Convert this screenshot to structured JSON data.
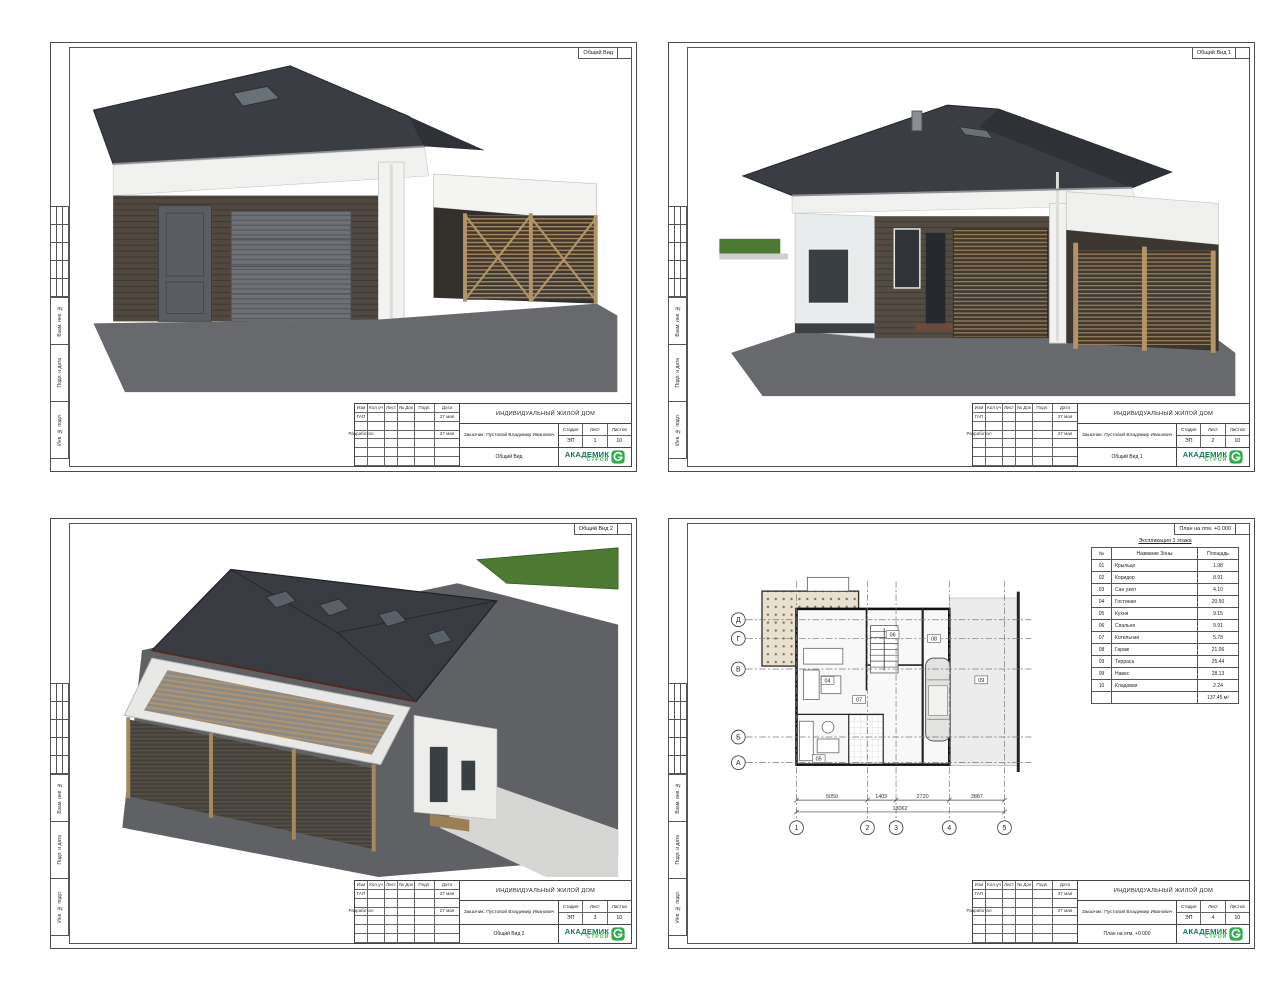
{
  "project": {
    "title": "ИНДИВИДУАЛЬНЫЙ ЖИЛОЙ ДОМ",
    "client": "Заказчик: Пустовой Владимир Иванович",
    "stage_label": "Стадия",
    "sheet_label": "Лист",
    "sheets_label": "Листов",
    "stage": "ЭП",
    "total_sheets": "10"
  },
  "titleblock": {
    "cols": [
      "Изм",
      "Кол.уч",
      "Лист",
      "№ Док",
      "Подп.",
      "Дата"
    ],
    "role1": "ГАП",
    "date1": "27 мая",
    "role2": "Разработал",
    "date2": "27 мая"
  },
  "logo": {
    "line1": "АКАДЕМИК",
    "line2": "СТРОЙ",
    "color1": "#0e7a4f",
    "color2": "#3bb54a"
  },
  "side_stamps": {
    "a": "Взам. инв. №",
    "b": "Подп. и дата",
    "c": "Инв. № подл."
  },
  "sheets": [
    {
      "name": "Общий Вид",
      "sheet_no": "1"
    },
    {
      "name": "Общий Вид 1",
      "sheet_no": "2"
    },
    {
      "name": "Общий Вид 2",
      "sheet_no": "3"
    },
    {
      "name": "План на отм. +0.000",
      "sheet_no": "4"
    }
  ],
  "explication": {
    "title": "Экспликация 1 этажа",
    "col_num": "№",
    "col_name": "Название Зоны",
    "col_area": "Площадь",
    "rows": [
      [
        "01",
        "Крыльцо",
        "1.98"
      ],
      [
        "02",
        "Коридор",
        "8.91"
      ],
      [
        "03",
        "Сан узел",
        "4.10"
      ],
      [
        "04",
        "Гостиная",
        "20.50"
      ],
      [
        "05",
        "Кухня",
        "9.15"
      ],
      [
        "06",
        "Спальня",
        "9.91"
      ],
      [
        "07",
        "Котельная",
        "5.78"
      ],
      [
        "08",
        "Гараж",
        "21.06"
      ],
      [
        "09",
        "Терраса",
        "25.44"
      ],
      [
        "09",
        "Навес",
        "28.13"
      ],
      [
        "10",
        "Кладовая",
        "2.24"
      ]
    ],
    "total": "137.45 м²"
  },
  "plan": {
    "axes_v": [
      "1",
      "2",
      "3",
      "4",
      "5"
    ],
    "axes_h": [
      "Д",
      "Г",
      "В",
      "Б",
      "А"
    ],
    "dims": [
      "5050",
      "1405",
      "2720",
      "3887"
    ],
    "dim_total": "13062",
    "room_tags": [
      "04",
      "05",
      "06",
      "07",
      "08",
      "09"
    ]
  },
  "palette": {
    "roof": "#3a3e44",
    "wood_siding": "#51483f",
    "carport_wood": "#b09468",
    "ground": "#67696d",
    "hedge": "#4c7a33",
    "white_wall": "#f1f1ef"
  }
}
